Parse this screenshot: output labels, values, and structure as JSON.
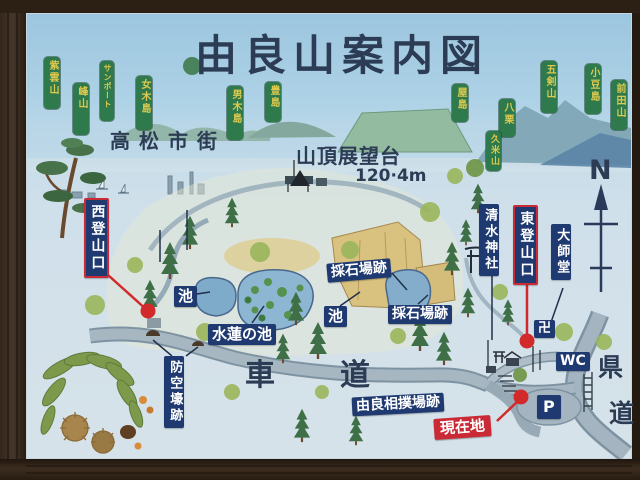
{
  "title": "由良山案内図",
  "region_labels": {
    "city": "高松市街",
    "summit_name": "山頂展望台",
    "summit_elevation": "120·4m",
    "compass_north": "N"
  },
  "peak_labels": [
    {
      "id": "shiunzan",
      "text": "紫雲山"
    },
    {
      "id": "mineyama",
      "text": "峰山"
    },
    {
      "id": "sunport",
      "text": "サンポート"
    },
    {
      "id": "megijima",
      "text": "女木島"
    },
    {
      "id": "ogijima",
      "text": "男木島"
    },
    {
      "id": "teshima",
      "text": "豊島"
    },
    {
      "id": "yashima",
      "text": "屋島"
    },
    {
      "id": "gokenzan",
      "text": "五剣山"
    },
    {
      "id": "shodoshima",
      "text": "小豆島"
    },
    {
      "id": "maedayama",
      "text": "前田山"
    },
    {
      "id": "yakuri",
      "text": "八栗"
    },
    {
      "id": "kumeyama",
      "text": "久米山"
    }
  ],
  "site_labels": {
    "west_trailhead": "西登山口",
    "east_trailhead": "東登山口",
    "shimizu_shrine": "清水神社",
    "daishido": "大師堂",
    "pond_left": "池",
    "lily_pond": "水蓮の池",
    "pond_right": "池",
    "quarry_upper": "採石場跡",
    "quarry_lower": "採石場跡",
    "air_raid_shelter": "防空壕跡",
    "car_road_char1": "車",
    "car_road_char2": "道",
    "sumo_ground": "由良相撲場跡",
    "current_location": "現在地",
    "toilet": "WC",
    "parking": "P",
    "temple_mark": "卍",
    "pref_road_char1": "県",
    "pref_road_char2": "道"
  },
  "colors": {
    "label_navy": "#1e3a70",
    "label_green": "#2f7a4c",
    "label_green_text": "#ddc94f",
    "accent_red": "#c92a35",
    "title_ink": "#2d3c55"
  }
}
